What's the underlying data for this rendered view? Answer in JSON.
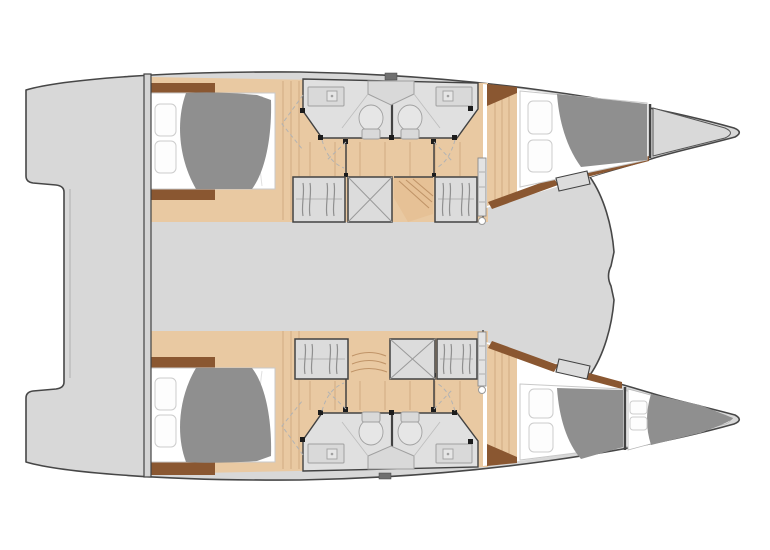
{
  "diagram": {
    "type": "floor-plan",
    "subject": "catamaran-yacht-interior-layout-top-view",
    "hulls": [
      {
        "name": "upper-hull",
        "areas": [
          "stern-platform",
          "aft-double-cabin",
          "ensuite-bathroom",
          "ensuite-bathroom",
          "wardrobe",
          "locker",
          "companionway-stairs",
          "wardrobe",
          "forward-double-cabin",
          "bow-locker"
        ]
      },
      {
        "name": "lower-hull",
        "areas": [
          "stern-platform",
          "aft-double-cabin",
          "ensuite-bathroom",
          "ensuite-bathroom",
          "wardrobe",
          "companionway-stairs",
          "locker",
          "wardrobe",
          "forward-double-cabin",
          "forepeak-berth"
        ]
      }
    ],
    "central_areas": [
      "aft-cockpit-deck",
      "bridgedeck",
      "foredeck"
    ]
  },
  "colors": {
    "page_bg": "#ffffff",
    "deck": "#d8d8d8",
    "outline": "#474747",
    "wall_dark": "#424242",
    "floor_wood": "#e9c9a2",
    "plank_line": "#cfa87e",
    "stairs_wood": "#e6c196",
    "stair_line": "#c09468",
    "furniture_brown": "#8a5731",
    "duvet_gray": "#8f8f8f",
    "mattress_white": "#ffffff",
    "pillow_stroke": "#cccccc",
    "bathroom_floor": "#e0e0e0",
    "fixture_line": "#a0a0a0",
    "cabinet_gray": "#dcdcdc",
    "hanger_line": "#8f8f8f",
    "dash_line": "#b3b3b3",
    "post_black": "#1c1c1c",
    "bow_locker_gray": "#d9d9d9",
    "door_leaf": "#e3e3e3",
    "vent_gray": "#707070"
  }
}
